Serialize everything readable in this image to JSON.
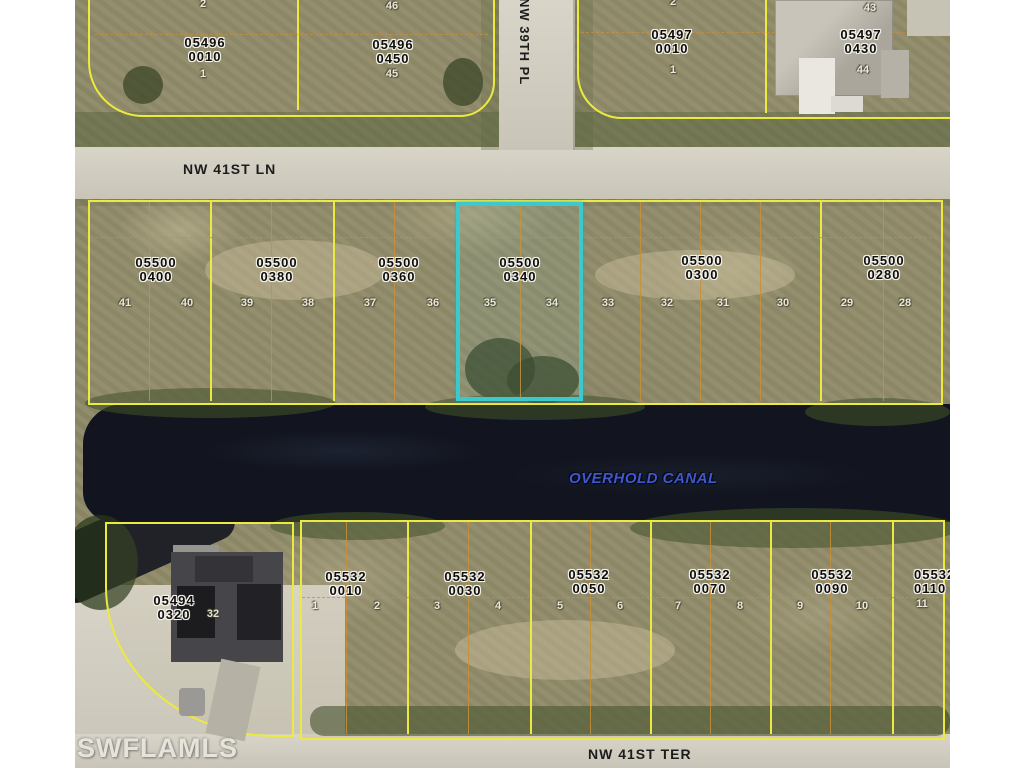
{
  "watermark": "SWFLAMLS",
  "canal": {
    "name": "OVERHOLD CANAL"
  },
  "streets": {
    "top": "NW 41ST LN",
    "vertical": "NW 39TH PL",
    "bottom": "NW 41ST TER"
  },
  "colors": {
    "highlight": "#3cc9ce",
    "parcel_line": "#ece93f",
    "lot_line": "#c98f35",
    "water": "#12151f",
    "road": "#d3cfc1",
    "label_text": "#0d0d0d"
  },
  "parcels": {
    "tl1": {
      "l1": "05496",
      "l2": "0010"
    },
    "tl2": {
      "l1": "05496",
      "l2": "0450"
    },
    "tr1": {
      "l1": "05497",
      "l2": "0010"
    },
    "tr2": {
      "l1": "05497",
      "l2": "0430"
    },
    "m1": {
      "l1": "05500",
      "l2": "0400"
    },
    "m2": {
      "l1": "05500",
      "l2": "0380"
    },
    "m3": {
      "l1": "05500",
      "l2": "0360"
    },
    "m4": {
      "l1": "05500",
      "l2": "0340",
      "highlighted": true
    },
    "m5": {
      "l1": "05500",
      "l2": "0300"
    },
    "m6": {
      "l1": "05500",
      "l2": "0280"
    },
    "bl": {
      "l1": "05494",
      "l2": "0320"
    },
    "b1": {
      "l1": "05532",
      "l2": "0010"
    },
    "b2": {
      "l1": "05532",
      "l2": "0030"
    },
    "b3": {
      "l1": "05532",
      "l2": "0050"
    },
    "b4": {
      "l1": "05532",
      "l2": "0070"
    },
    "b5": {
      "l1": "05532",
      "l2": "0090"
    },
    "b6": {
      "l1": "05532",
      "l2": "0110"
    }
  },
  "lots": {
    "top_left": [
      "2",
      "1",
      "46",
      "45"
    ],
    "top_right": [
      "2",
      "1",
      "43",
      "44"
    ],
    "middle": [
      "41",
      "40",
      "39",
      "38",
      "37",
      "36",
      "35",
      "34",
      "33",
      "32",
      "31",
      "30",
      "29",
      "28"
    ],
    "bottom": [
      "1",
      "2",
      "3",
      "4",
      "5",
      "6",
      "7",
      "8",
      "9",
      "10",
      "11"
    ],
    "bottom_left": "32"
  }
}
